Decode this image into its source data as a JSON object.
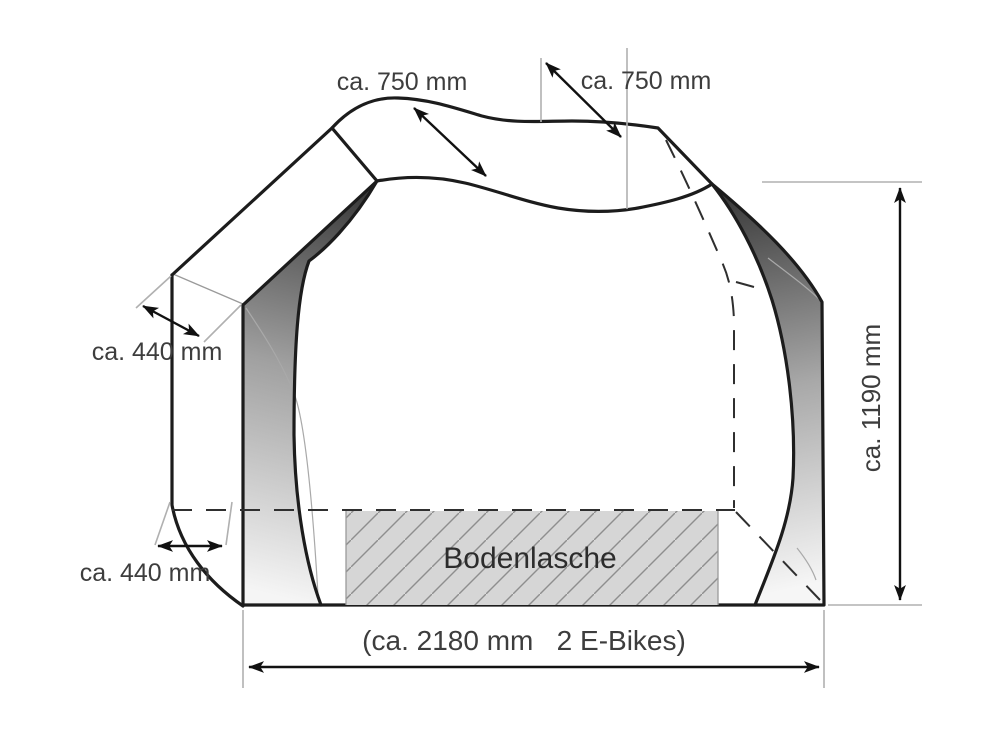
{
  "labels": {
    "roof_width_left": "ca. 750 mm",
    "roof_width_right": "ca. 750 mm",
    "side_depth_upper": "ca. 440 mm",
    "side_depth_lower": "ca. 440 mm",
    "height": "ca. 1190 mm",
    "total_width": "(ca. 2180 mm   2 E-Bikes)",
    "ground_flap": "Bodenlasche"
  },
  "colors": {
    "outline": "#1c1c1c",
    "label_text": "#3d3d3d",
    "extension_line": "#b0b0b0",
    "hidden_edge": "#2f2f2f",
    "hatch_fill": "#d6d6d6",
    "hatch_line": "#8e8e8e",
    "shading_dark": "#3a3a3a",
    "shading_light": "#f5f5f5",
    "background": "#ffffff"
  }
}
